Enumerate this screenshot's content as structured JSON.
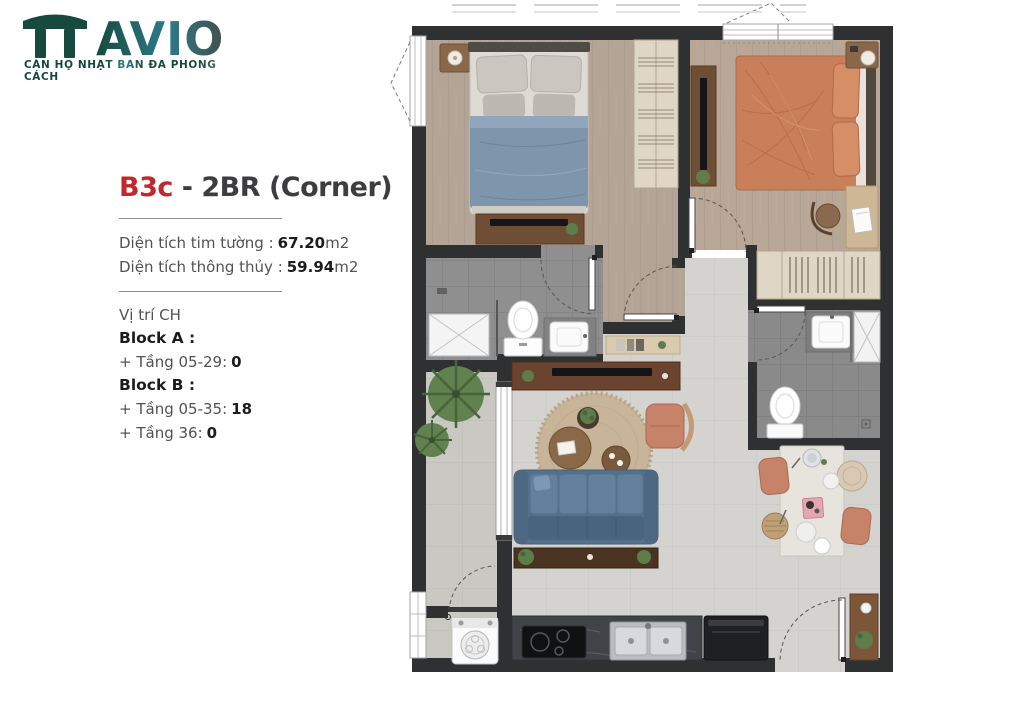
{
  "brand": {
    "logo_text": "AVIO",
    "tagline": "CĂN HỘ NHẬT BẢN ĐA PHONG CÁCH"
  },
  "unit": {
    "code": "B3c",
    "name": " - 2BR (Corner)",
    "area1_label": "Diện tích tim tường :",
    "area1_value": "67.20",
    "area1_unit": "m2",
    "area2_label": "Diện tích thông thủy :",
    "area2_value": "59.94",
    "area2_unit": "m2"
  },
  "location": {
    "heading": "Vị trí CH",
    "block_a": {
      "label": "Block A :",
      "row1_label": "+ Tầng 05-29:",
      "row1_value": "0"
    },
    "block_b": {
      "label": "Block B :",
      "row1_label": "+ Tầng 05-35:",
      "row1_value": "18",
      "row2_label": "+ Tầng 36:",
      "row2_value": "0"
    }
  },
  "colors": {
    "accent_red": "#c0282e",
    "brand_dark": "#174a3e",
    "brand_teal": "#2e7f8e",
    "wall": "#2e3032",
    "wood_floor": "#b3a496",
    "wood_floor2": "#b8a797",
    "tile_light": "#d4d3cf",
    "tile_bath": "#8f8f8f",
    "tile_balcony": "#c9c8c3",
    "bed_blue": "#7e95ab",
    "bed_orange": "#c9805a",
    "sofa_blue": "#54708c",
    "rug_tan": "#c8b499",
    "furniture_walnut": "#6f4e36",
    "wardrobe_oak": "#e0d6c5"
  }
}
